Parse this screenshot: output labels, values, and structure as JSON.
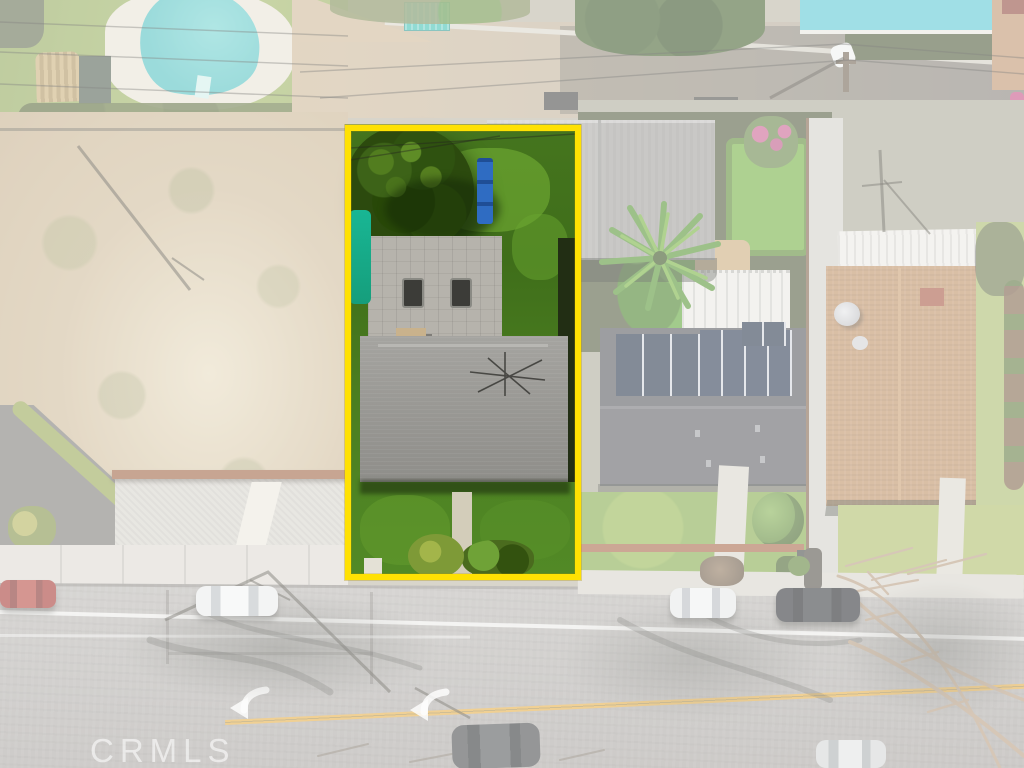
{
  "watermark": {
    "text": "CRMLS"
  },
  "boundary": {
    "color": "#FFE103"
  },
  "palette": {
    "fade_overlay": "#FFFFFF",
    "boundary_yellow": "#FFE103",
    "pool_water": "#5AC9C6",
    "upper_pool_water": "#52C5D2",
    "tarp_teal": "#18B694",
    "teal_canopy": "#38BDB0",
    "solar_panel_navy": "#1E2C42",
    "featured_lawn_green": "#4A7D20",
    "faded_lawn_green": "#9DB45E",
    "main_roof_gray": "#9A9995",
    "garage_roof_gray": "#A6A5A1",
    "neighbor_roof_gray": "#56575B",
    "brown_roof_tan": "#BB8A5C",
    "street_asphalt": "#AEABA7",
    "dirt_lot_tan": "#CDB996",
    "gravel_gray": "#D6D3CB",
    "road_yellow_line": "#E3A93C",
    "road_white_line": "#FAFAF8",
    "brick_wall_rust": "#A35F3E"
  }
}
